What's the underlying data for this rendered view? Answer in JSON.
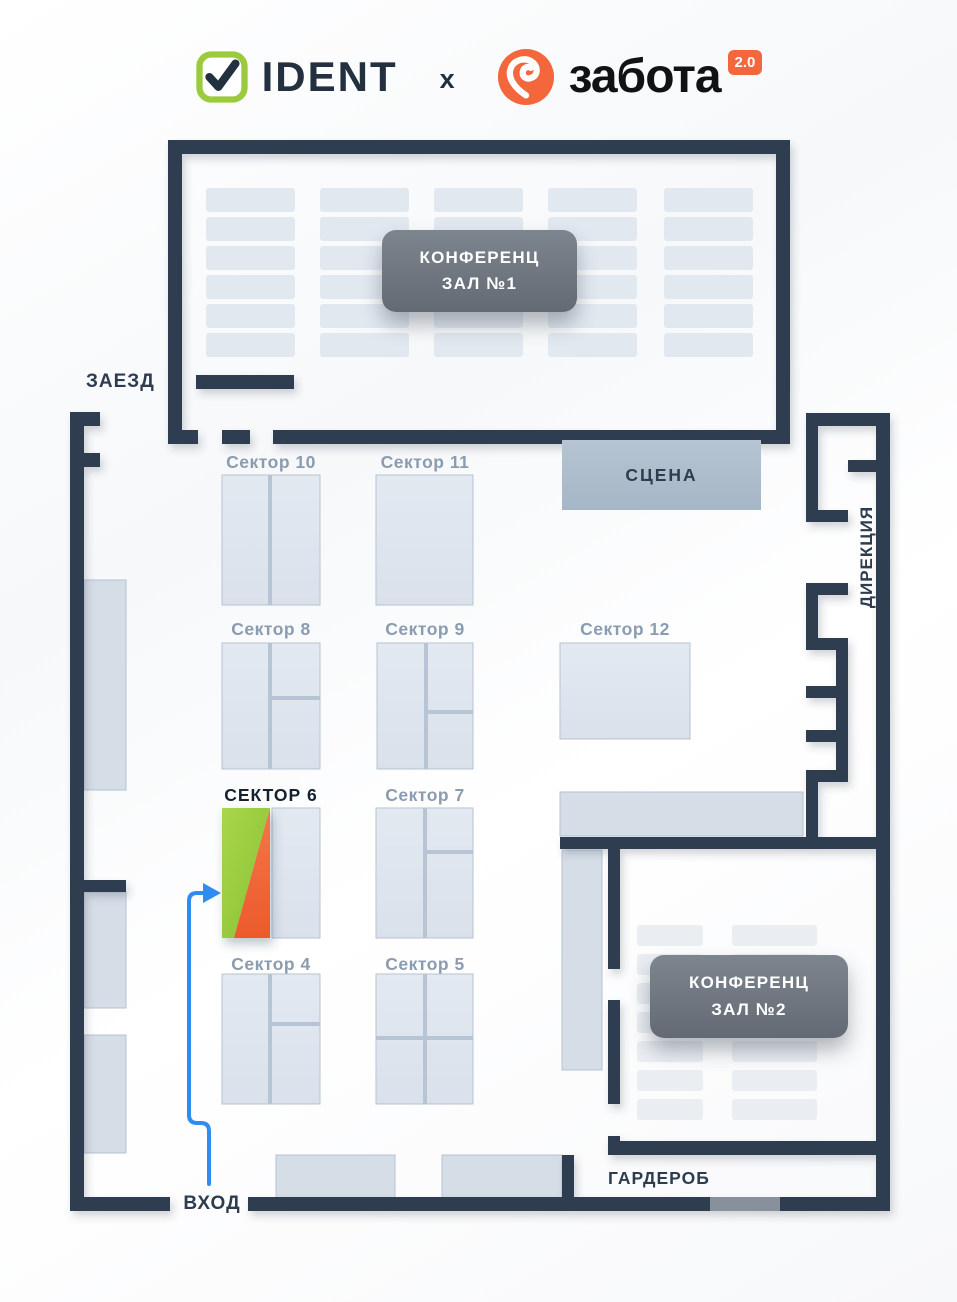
{
  "header": {
    "left_brand": "IDENT",
    "separator": "x",
    "right_brand": "забота",
    "right_brand_version": "2.0"
  },
  "plan": {
    "labels": {
      "drive_in": "ЗАЕЗД",
      "entrance": "ВХОД",
      "cloakroom": "ГАРДЕРОБ",
      "stage": "СЦЕНА",
      "direction_office": "ДИРЕКЦИЯ",
      "conf_hall_1_line1": "КОНФЕРЕНЦ",
      "conf_hall_1_line2": "ЗАЛ №1",
      "conf_hall_2_line1": "КОНФЕРЕНЦ",
      "conf_hall_2_line2": "ЗАЛ №2"
    },
    "sectors": [
      {
        "label": "Сектор 10",
        "highlighted": false
      },
      {
        "label": "Сектор 11",
        "highlighted": false
      },
      {
        "label": "Сектор 8",
        "highlighted": false
      },
      {
        "label": "Сектор 9",
        "highlighted": false
      },
      {
        "label": "Сектор 12",
        "highlighted": false
      },
      {
        "label": "СЕКТОР 6",
        "highlighted": true
      },
      {
        "label": "Сектор 7",
        "highlighted": false
      },
      {
        "label": "Сектор 4",
        "highlighted": false
      },
      {
        "label": "Сектор 5",
        "highlighted": false
      }
    ],
    "highlighted_sector": "СЕКТОР 6"
  },
  "colors": {
    "wall": "#2e3c4f",
    "accent_green": "#9bcb3d",
    "accent_orange": "#f2683c",
    "arrow_blue": "#2f8df2",
    "booth_fill": "#dfe5ee",
    "stage_fill": "#aebecd",
    "label_gray_blue": "#8b9cb1"
  }
}
